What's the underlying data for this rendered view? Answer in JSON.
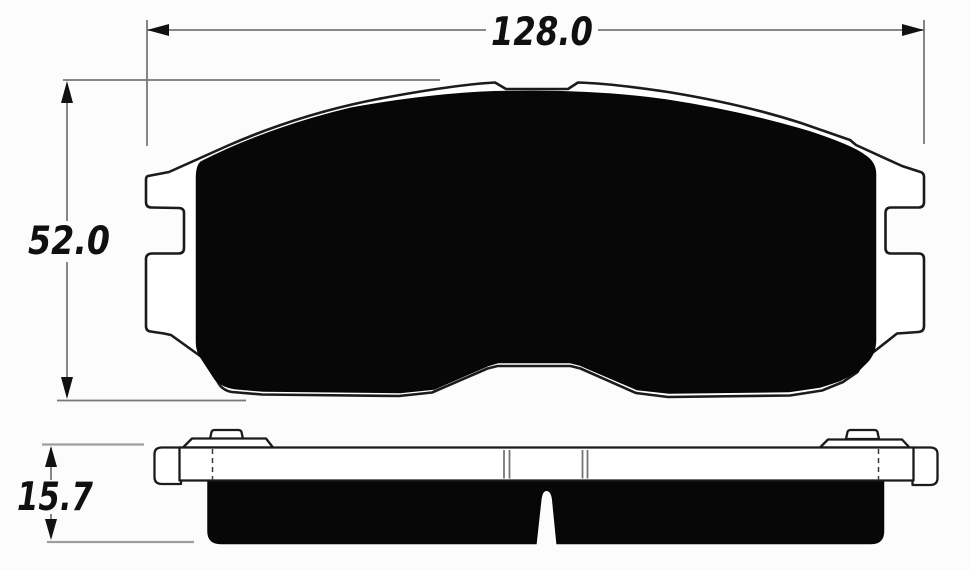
{
  "drawing": {
    "kind": "brake-pad-two-view-technical-drawing",
    "dimensions": {
      "width": {
        "value": "128.0"
      },
      "height": {
        "value": "52.0"
      },
      "thickness": {
        "value": "15.7"
      }
    },
    "colors": {
      "background": "#fcfcfc",
      "outline_stroke": "#1b1b1b",
      "friction_fill": "#070707",
      "dimension_line": "#787878",
      "light_extension_line": "#9e9e9e",
      "label_text": "#101010"
    }
  }
}
